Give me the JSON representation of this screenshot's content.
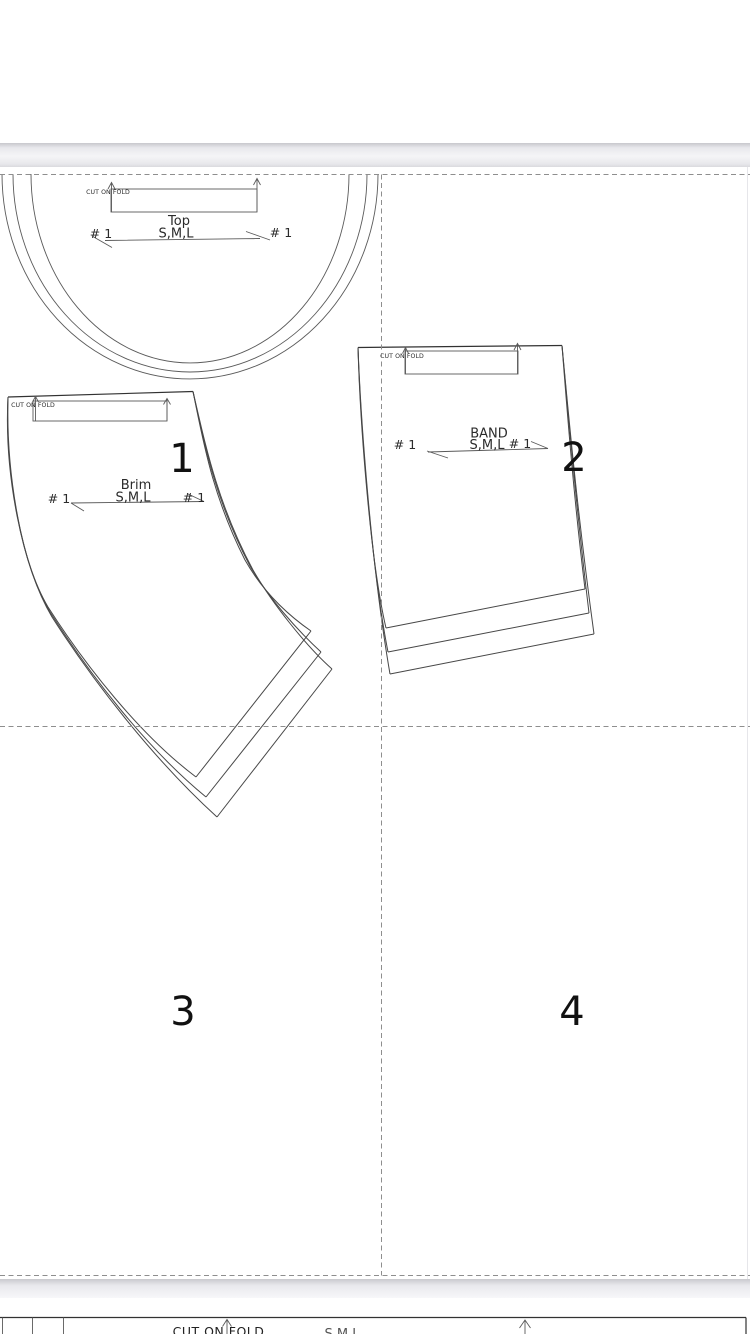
{
  "document": {
    "tile_numbers": [
      "1",
      "2",
      "3",
      "4"
    ],
    "pieces": {
      "top": {
        "name": "Top",
        "sizes": "S,M,L",
        "fold_label": "CUT ON FOLD",
        "notch_left": "# 1",
        "notch_right": "# 1"
      },
      "brim": {
        "name": "Brim",
        "sizes": "S,M,L",
        "fold_label": "CUT ON FOLD",
        "notch_left": "# 1",
        "notch_right": "# 1"
      },
      "band": {
        "name": "BAND",
        "sizes": "S,M,L",
        "fold_label": "CUT ON FOLD",
        "notch_left": "# 1",
        "notch_right": "# 1"
      },
      "next_page": {
        "fold_label": "CUT ON FOLD",
        "sizes_partial": "S,M,L"
      }
    },
    "colors": {
      "pattern_line": "#474747",
      "tile_dash": "#8e8e8e",
      "page_separator": "#e9e9ed",
      "text": "#2b2b2b"
    }
  }
}
